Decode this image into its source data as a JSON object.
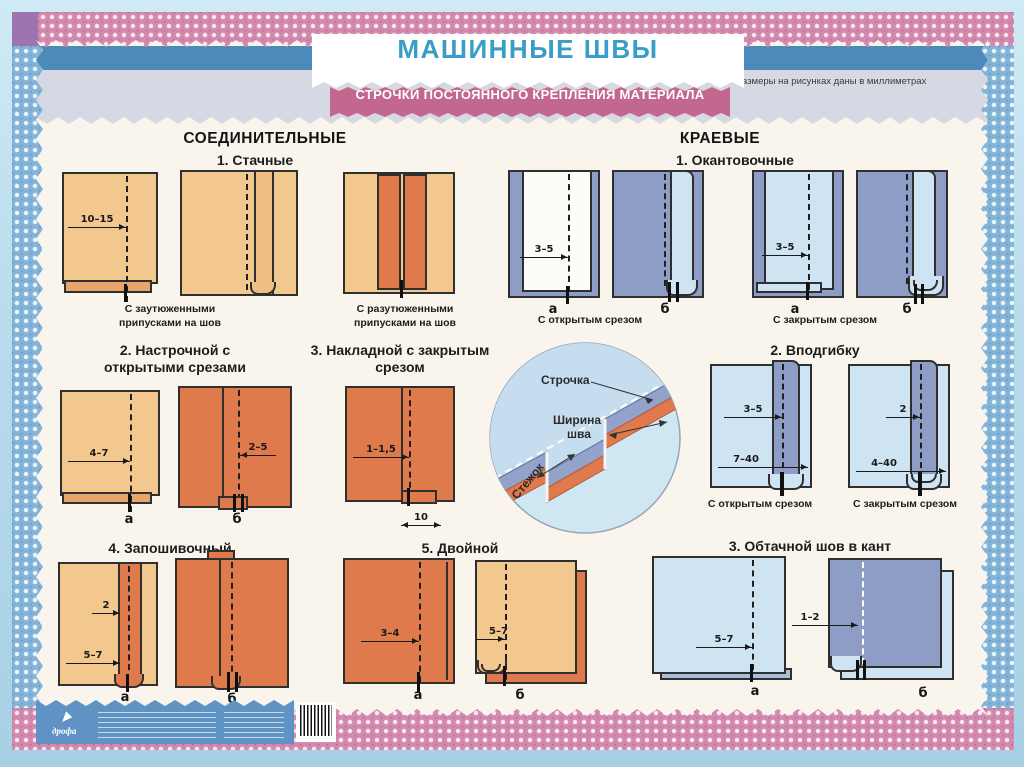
{
  "poster": {
    "title": "МАШИННЫЕ ШВЫ",
    "subtitle": "СТРОЧКИ ПОСТОЯННОГО КРЕПЛЕНИЯ МАТЕРИАЛА",
    "note": "Размеры на рисунках даны в миллиметрах",
    "publisher": "дрофа"
  },
  "labels": {
    "a": "а",
    "b": "б"
  },
  "left": {
    "header": "СОЕДИНИТЕЛЬНЫЕ",
    "s1": {
      "title": "1. Стачные",
      "dim": "10–15",
      "caption1": "С заутюженными припусками на шов",
      "caption2": "С разутюженными припусками на шов"
    },
    "s2": {
      "title": "2. Настрочной с открытыми срезами",
      "dim_a": "4–7",
      "dim_b": "2–5"
    },
    "s3": {
      "title": "3. Накладной с закрытым срезом",
      "dim1": "1–1,5",
      "dim2": "10"
    },
    "s4": {
      "title": "4. Запошивочный",
      "dim1": "2",
      "dim2": "5–7"
    },
    "s5": {
      "title": "5. Двойной",
      "dim_a": "3–4",
      "dim_b": "5–7"
    }
  },
  "right": {
    "header": "КРАЕВЫЕ",
    "s1": {
      "title": "1. Окантовочные",
      "dim_a": "3–5",
      "dim_c": "3–5",
      "caption_open": "С открытым срезом",
      "caption_closed": "С закрытым срезом"
    },
    "s2": {
      "title": "2. Вподгибку",
      "dim_a1": "3–5",
      "dim_a2": "7–40",
      "dim_b1": "2",
      "dim_b2": "4–40",
      "caption_open": "С открытым срезом",
      "caption_closed": "С закрытым срезом"
    },
    "s3": {
      "title": "3. Обтачной шов в кант",
      "dim_a": "5–7",
      "dim_b": "1–2"
    }
  },
  "inset": {
    "strochka": "Строчка",
    "shirina1": "Ширина",
    "shirina2": "шва",
    "stezhok": "Стежок"
  },
  "colors": {
    "title_blue": "#3a9dc8",
    "banner_pink": "#c2688f",
    "frame_blue": "#4d8ab9",
    "fabric_beige": "#f2c88e",
    "fabric_orange": "#de7a4c",
    "fabric_lightblue": "#cfe4f2",
    "fabric_purple": "#8e9dc6"
  }
}
